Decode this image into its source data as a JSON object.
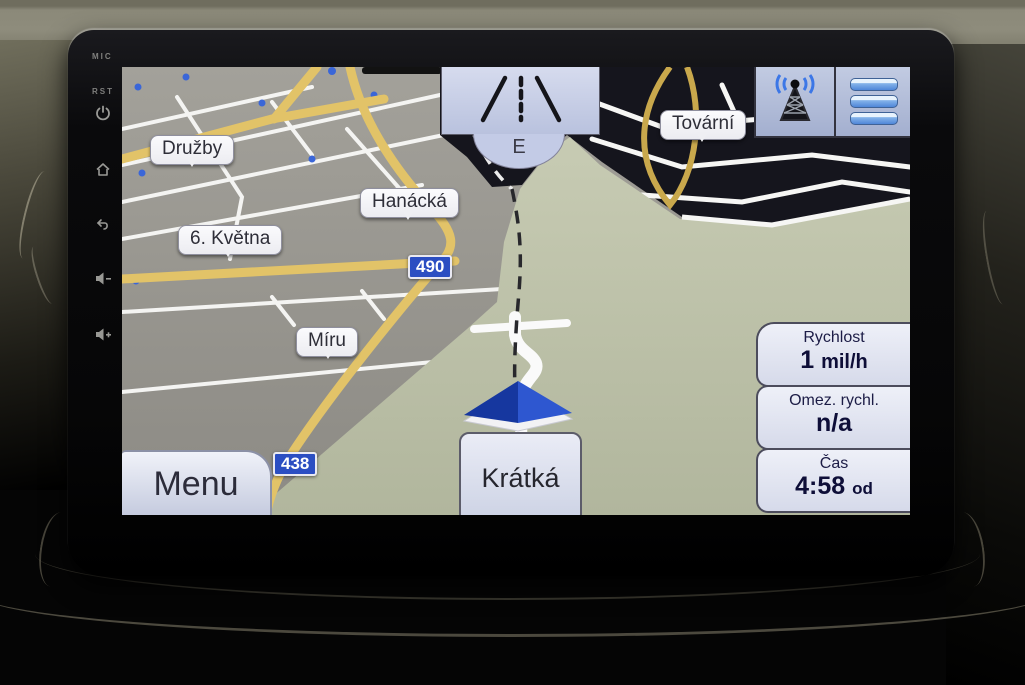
{
  "bezel": {
    "mic_label": "MIC",
    "rst_label": "RST",
    "buttons": [
      "power-icon",
      "home-icon",
      "back-icon",
      "volume-down-icon",
      "volume-up-icon"
    ]
  },
  "nav_screen": {
    "lane_sign": {
      "pictogram": "highway-lanes-icon",
      "exit_letter": "E"
    },
    "top_buttons": {
      "left_icon": "gps-antenna-icon",
      "right_icon": "route-list-icon"
    },
    "street_labels": {
      "druzby": "Družby",
      "hanacka": "Hanácká",
      "kvetna_6": "6. Května",
      "miru": "Míru",
      "tovarni": "Tovární",
      "kratka": "Krátká"
    },
    "road_badges": {
      "b490": "490",
      "b438": "438"
    },
    "menu_button_label": "Menu",
    "info_panel": {
      "speed_label": "Rychlost",
      "speed_value": "1",
      "speed_unit": "mil/h",
      "limit_label": "Omez. rychl.",
      "limit_value": "n/a",
      "time_label": "Čas",
      "time_value": "4:58",
      "time_suffix": "od"
    }
  },
  "colors": {
    "road_badge_blue": "#2b4ec2",
    "label_bubble": "#f4f4f6",
    "panel_bg": "#e0e3f1",
    "sign_bg": "#c9d0e8",
    "map_gray": "#98968f",
    "map_green": "#bcc0a9",
    "map_buildings": "#15151d",
    "road_yellow": "#e2c368",
    "route_arrow_blue": "#2450c8"
  }
}
